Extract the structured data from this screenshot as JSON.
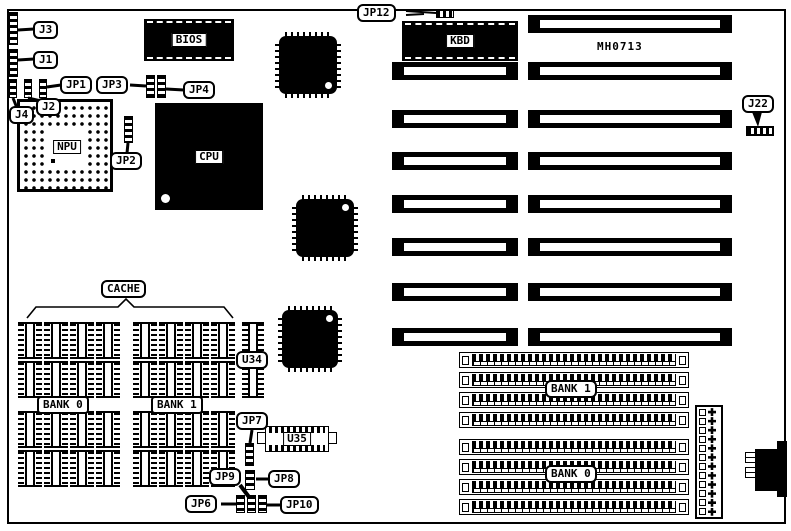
{
  "board_model": "MH0713",
  "chips": {
    "bios": "BIOS",
    "cpu": "CPU",
    "npu": "NPU",
    "kbd": "KBD",
    "u34": "U34",
    "u35": "U35"
  },
  "connector_labels": {
    "j1": "J1",
    "j2": "J2",
    "j3": "J3",
    "j4": "J4",
    "j22": "J22"
  },
  "jumper_labels": {
    "jp1": "JP1",
    "jp2": "JP2",
    "jp3": "JP3",
    "jp4": "JP4",
    "jp6": "JP6",
    "jp7": "JP7",
    "jp8": "JP8",
    "jp9": "JP9",
    "jp10": "JP10",
    "jp12": "JP12"
  },
  "cache": {
    "label": "CACHE",
    "bank0_label": "BANK 0",
    "bank1_label": "BANK 1",
    "columns_per_bank": 4,
    "sockets_per_column": 4
  },
  "memory": {
    "bank1_label": "BANK 1",
    "bank0_label": "BANK 0",
    "sockets_per_bank": 4
  },
  "expansion_slots": {
    "row_count": 8
  },
  "power_connector": {
    "pin_rows": 12
  },
  "colors": {
    "ink": "#000000",
    "background": "#ffffff"
  }
}
